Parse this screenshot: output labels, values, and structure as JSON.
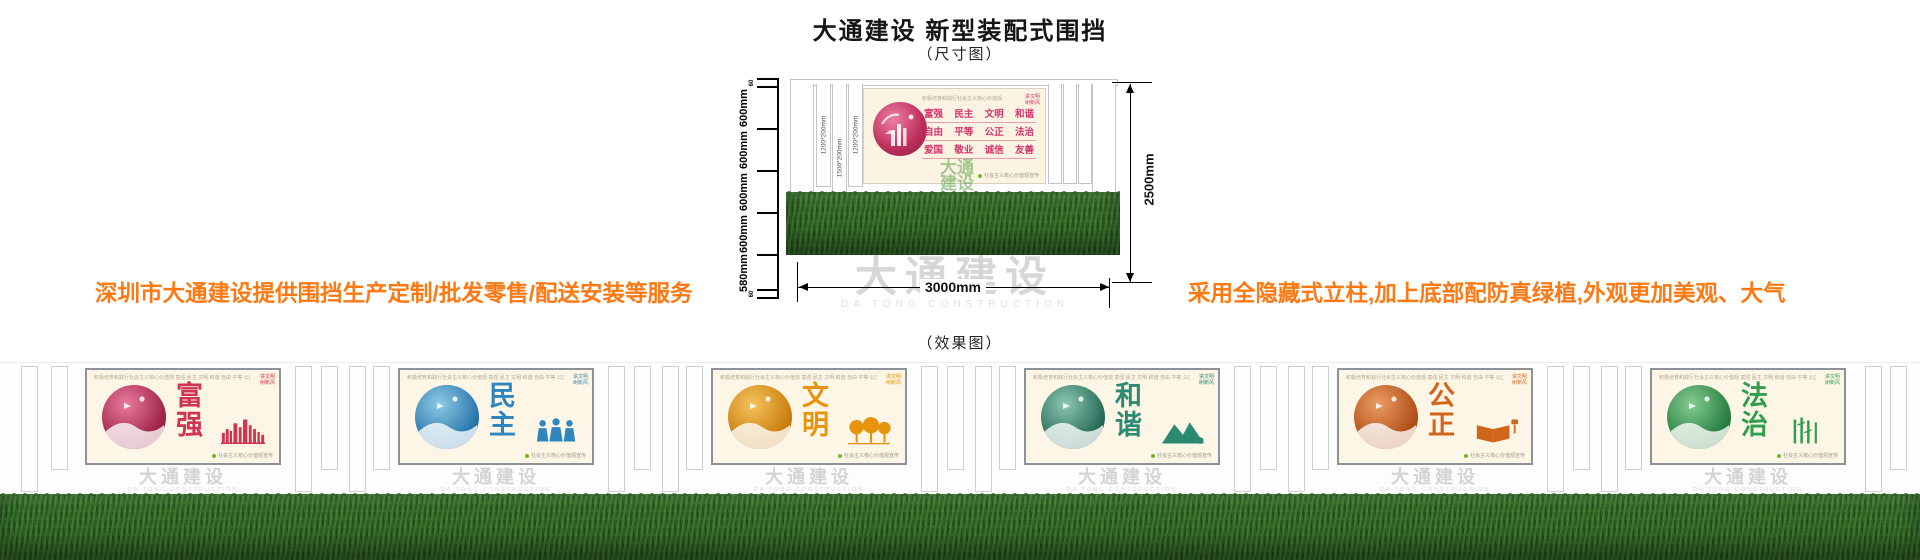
{
  "title": "大通建设 新型装配式围挡",
  "subtitle": "（尺寸图）",
  "effect_label": "（效果图）",
  "notes": {
    "left": "深圳市大通建设提供围挡生产定制/批发零售/配送安装等服务",
    "right": "采用全隐藏式立柱,加上底部配防真绿植,外观更加美观、大气",
    "color": "#ff7812"
  },
  "brand_watermark": {
    "cn": "大通建设",
    "en": "DA TONG CONSTRUCTION"
  },
  "diagram": {
    "side_segments": [
      {
        "label": "60",
        "tiny": true
      },
      {
        "label": "600mm"
      },
      {
        "label": "600mm"
      },
      {
        "label": "600mm"
      },
      {
        "label": "600mm"
      },
      {
        "label": "580mm"
      },
      {
        "label": "60",
        "tiny": true
      }
    ],
    "post_labels": [
      "1200*200mm",
      "1500*200mm",
      "1200*200mm"
    ],
    "overall_height": "2500mm",
    "overall_width": "3000mm",
    "panel": {
      "header": "积极培育和践行社会主义核心价值观",
      "corner_lines": [
        "讲文明",
        "树新风"
      ],
      "values_rows": [
        [
          "富强",
          "民主",
          "文明",
          "和谐"
        ],
        [
          "自由",
          "平等",
          "公正",
          "法治"
        ],
        [
          "爱国",
          "敬业",
          "诚信",
          "友善"
        ]
      ],
      "footnote": "社会主义核心价值观宣传",
      "accent": "#d6336c",
      "watermark_lines": [
        "大通",
        "建设"
      ]
    }
  },
  "effect": {
    "common": {
      "header": "积极培育和践行社会主义核心价值观  富强 民主 文明 和谐 自由 平等 公正 法治 爱国 敬业 诚信 友善",
      "corner_lines": [
        "讲文明",
        "树新风"
      ],
      "footnote": "社会主义核心价值观宣传"
    },
    "panels": [
      {
        "word": "富强",
        "accent": "#cf3453",
        "circle_from": "#ea7b9d",
        "circle_to": "#93173c",
        "motif": "city"
      },
      {
        "word": "民主",
        "accent": "#2f86bf",
        "circle_from": "#8ecbe4",
        "circle_to": "#1c6aa6",
        "motif": "people"
      },
      {
        "word": "文明",
        "accent": "#e8930c",
        "circle_from": "#f6c35d",
        "circle_to": "#c27403",
        "motif": "trees"
      },
      {
        "word": "和谐",
        "accent": "#2c8a72",
        "circle_from": "#8cc7b4",
        "circle_to": "#19604c",
        "motif": "mountain"
      },
      {
        "word": "公正",
        "accent": "#d2651c",
        "circle_from": "#eb9d63",
        "circle_to": "#a8430e",
        "motif": "book"
      },
      {
        "word": "法治",
        "accent": "#2f9e4f",
        "circle_from": "#85cd92",
        "circle_to": "#1b7234",
        "motif": "bamboo"
      }
    ]
  }
}
